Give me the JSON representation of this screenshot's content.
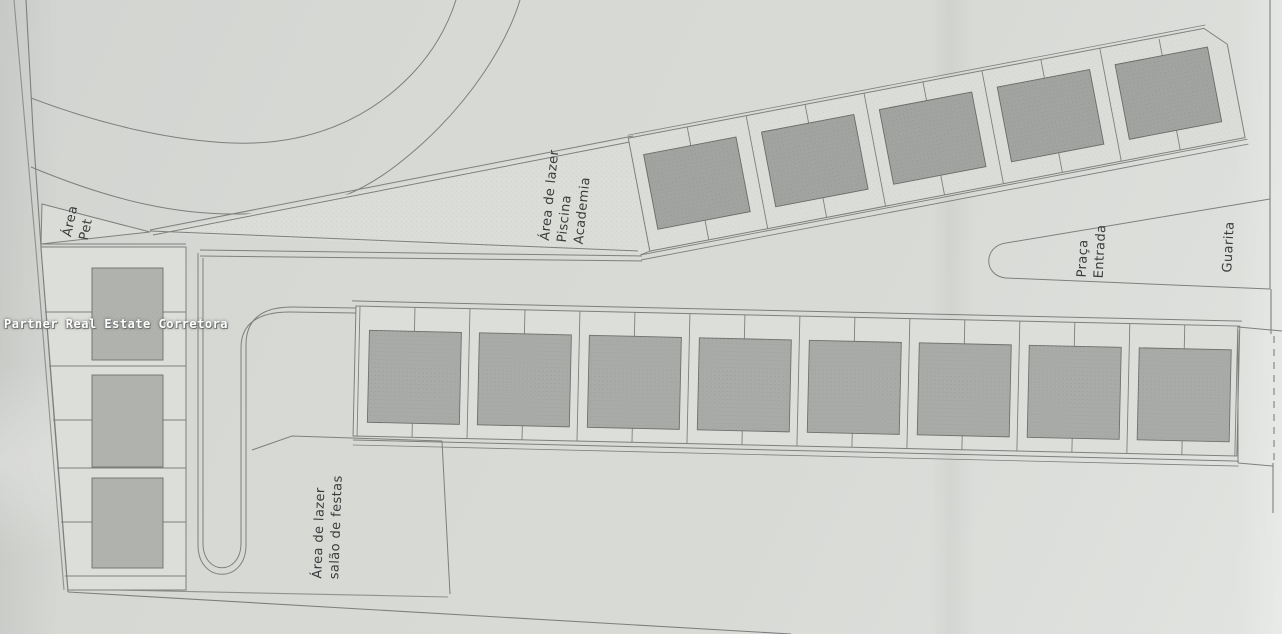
{
  "watermark": {
    "text": "Partner Real Estate Corretora",
    "color": "#ffffff"
  },
  "site_plan": {
    "labels": {
      "pet": {
        "line1": "Área",
        "line2": "Pet"
      },
      "leisure_pool": {
        "line1": "Área de lazer",
        "line2": "Piscina",
        "line3": "Academia"
      },
      "entrance_square": {
        "line1": "Praça",
        "line2": "Entrada"
      },
      "guardhouse": {
        "text": "Guarita"
      },
      "party_hall": {
        "line1": "Área de lazer",
        "line2": "salão de festas"
      }
    },
    "colors": {
      "paper": "#d7d9d5",
      "line": "#7e807e",
      "lot_fill": "#dcded9",
      "building_fill": "#a9aba8",
      "building_fill_dark": "#a2a4a1",
      "building_fill_light": "#b0b2ae",
      "label_color": "#3a3c3e",
      "watermark_color": "#ffffff"
    }
  }
}
